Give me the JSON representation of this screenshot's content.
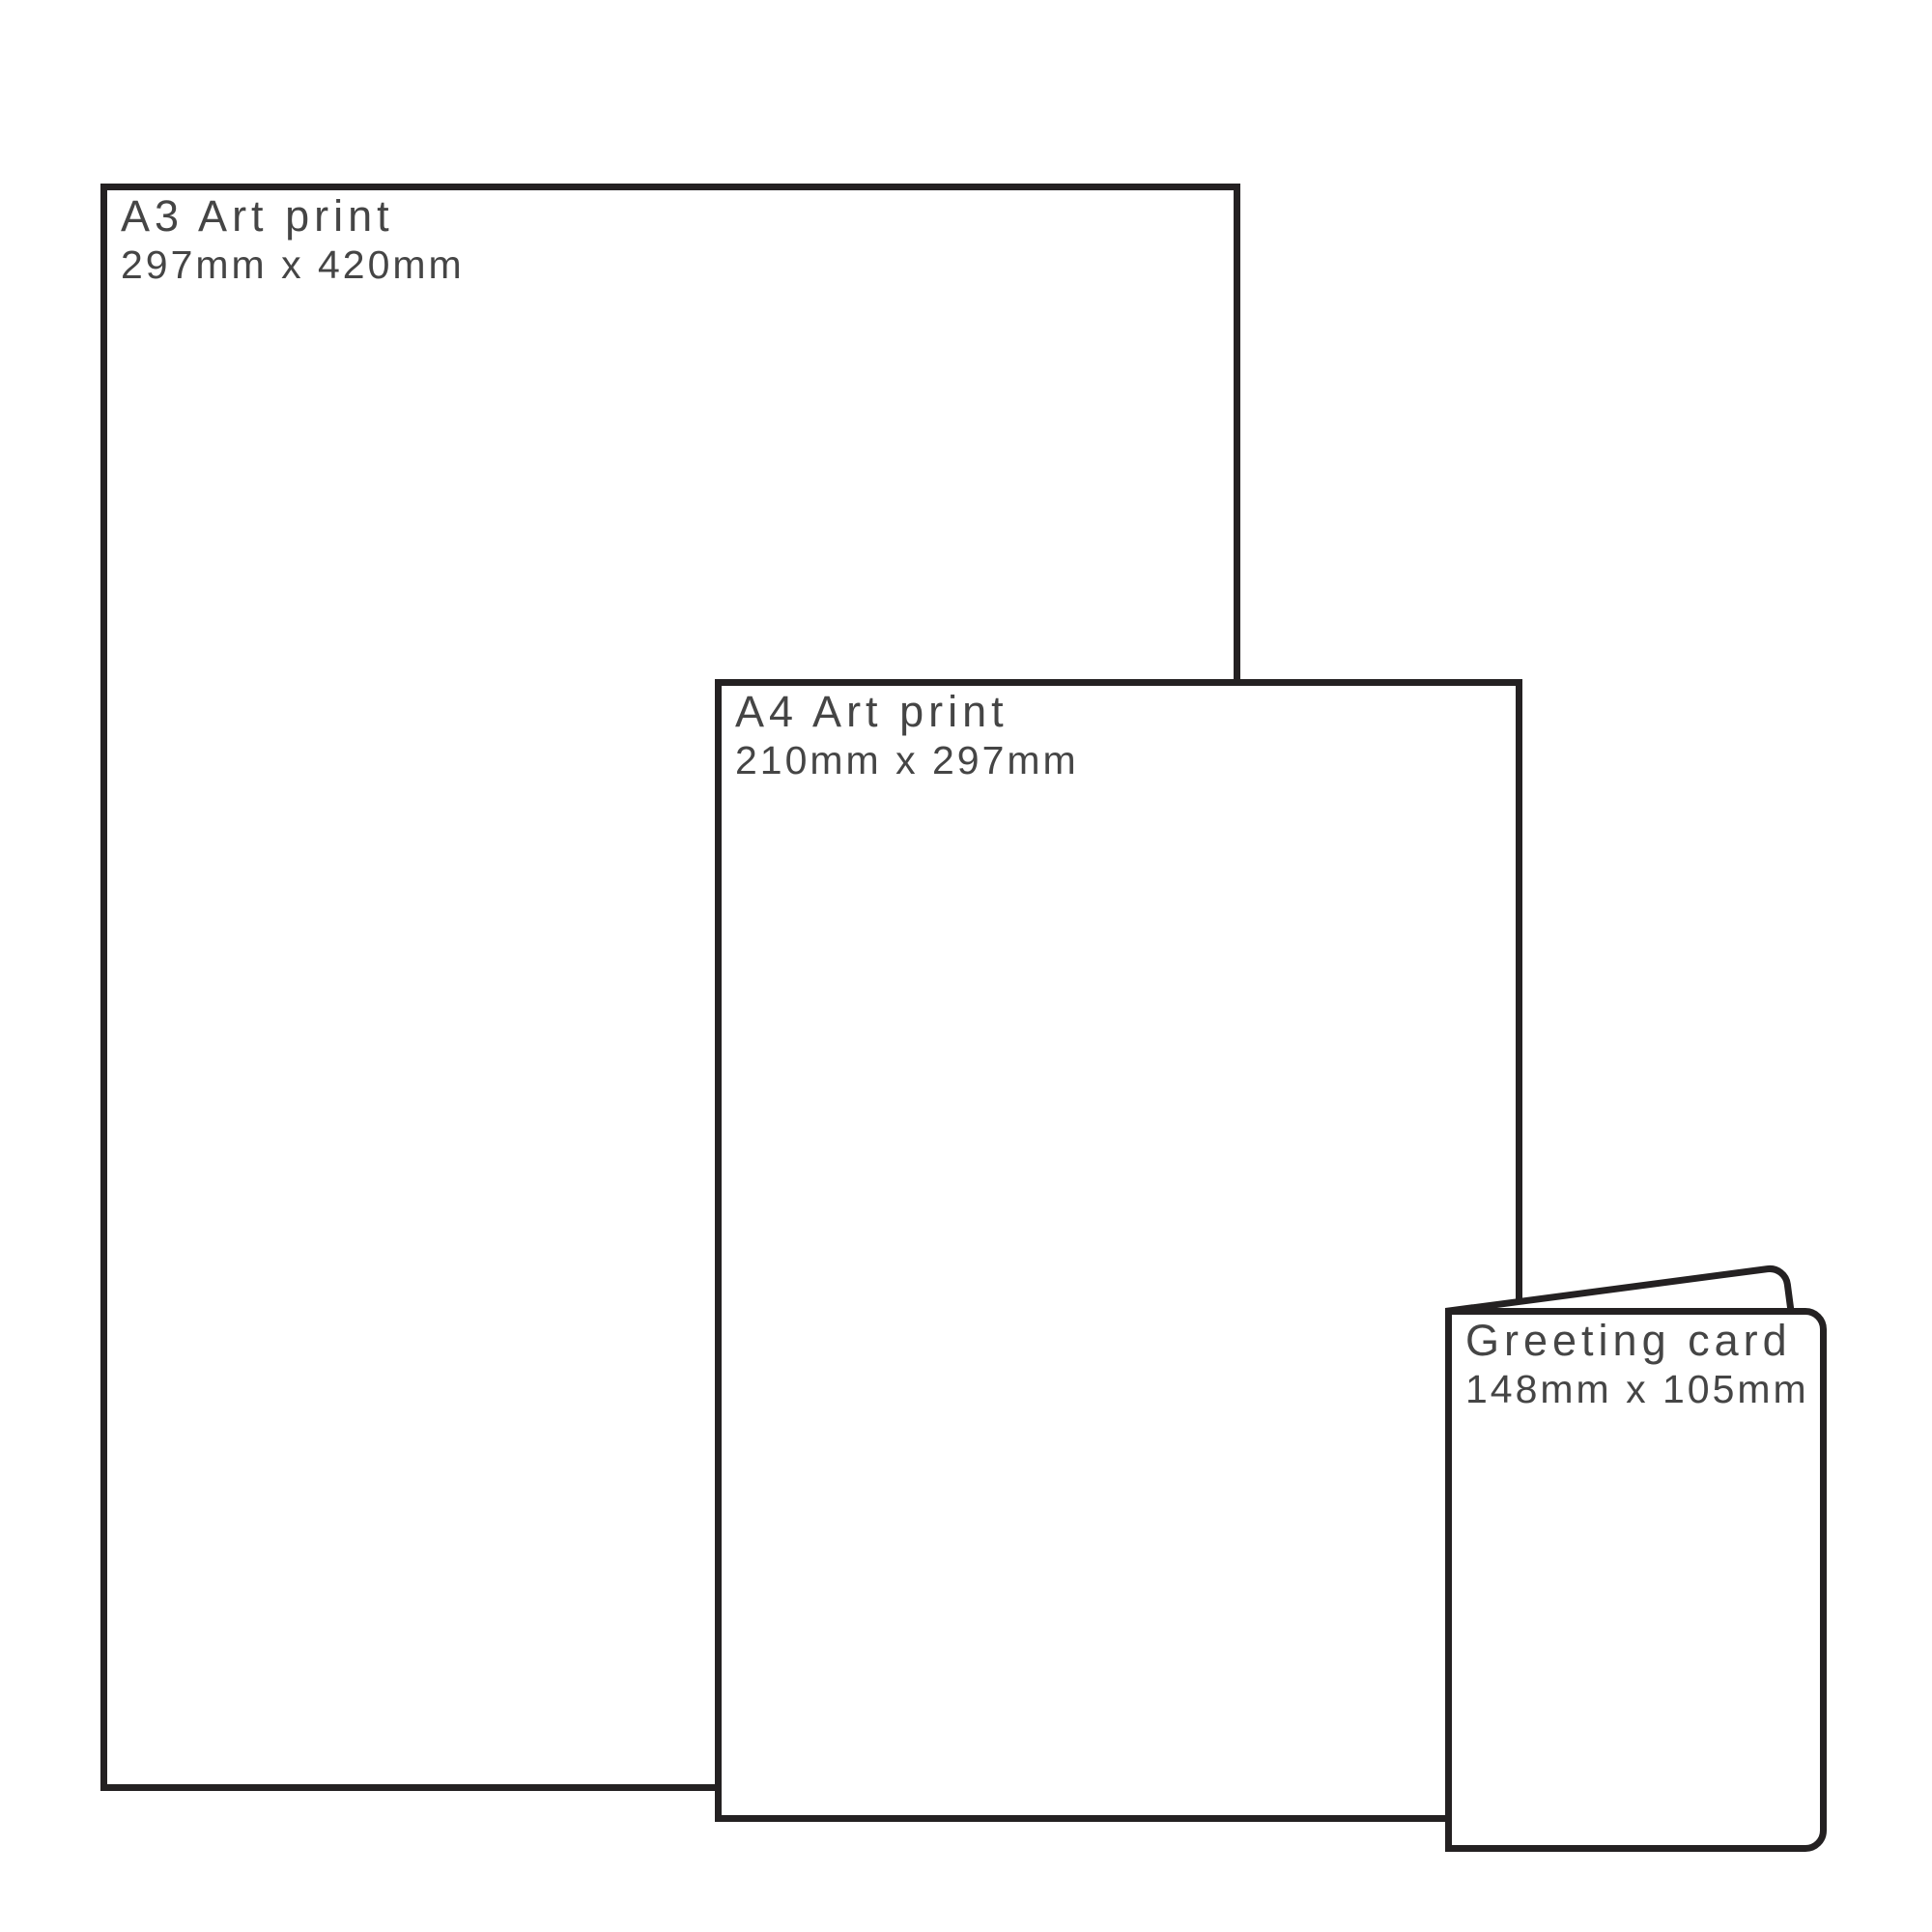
{
  "diagram": {
    "background_color": "#ffffff",
    "outline_color": "#242122",
    "text_color": "#454545"
  },
  "items": [
    {
      "name": "a3-art-print",
      "title": "A3 Art print",
      "dimensions": "297mm x 420mm"
    },
    {
      "name": "a4-art-print",
      "title": "A4 Art print",
      "dimensions": "210mm x 297mm"
    },
    {
      "name": "greeting-card",
      "title": "Greeting card",
      "dimensions": "148mm x 105mm"
    }
  ]
}
